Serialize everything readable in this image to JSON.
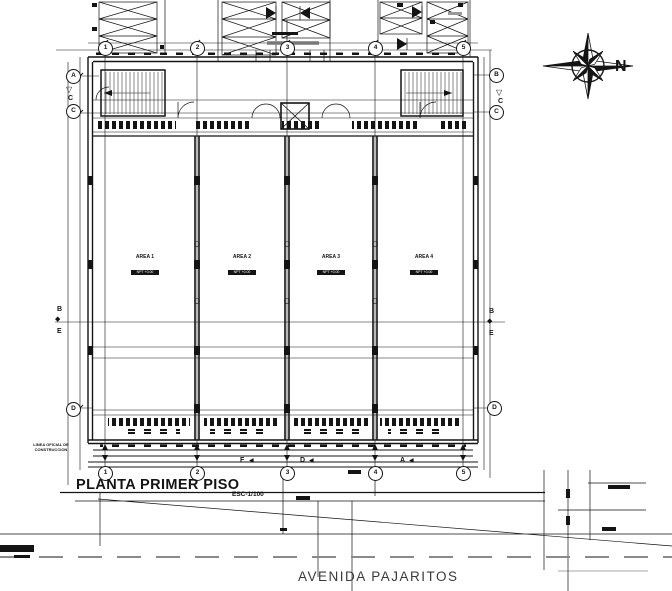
{
  "drawing": {
    "title": "PLANTA PRIMER PISO",
    "scale": "ESC-1/100",
    "street_name": "AVENIDA PAJARITOS",
    "north_label": "N",
    "margin_note_line1": "LINEA OFICIAL DE",
    "margin_note_line2": "CONSTRUCCION"
  },
  "grid": {
    "top_cols": [
      "1",
      "2",
      "3",
      "4",
      "5"
    ],
    "bottom_cols": [
      "1",
      "2",
      "3",
      "4",
      "5"
    ],
    "left_rows": [
      "A",
      "C",
      "D"
    ],
    "right_rows": [
      "B",
      "C",
      "D"
    ]
  },
  "section_markers": {
    "top_left": "C",
    "top_right": "C",
    "left_b": "B",
    "left_e": "E",
    "right_b": "B",
    "right_e": "E",
    "bottom_f": "F",
    "bottom_d": "D",
    "bottom_a": "A",
    "down_triangle": "▽",
    "left_triangle": "◀",
    "diamond": "◆"
  },
  "rooms": [
    {
      "name": "AREA 1",
      "level": "NPT +0.00"
    },
    {
      "name": "AREA 2",
      "level": "NPT +0.00"
    },
    {
      "name": "AREA 3",
      "level": "NPT +0.00"
    },
    {
      "name": "AREA 4",
      "level": "NPT +0.00"
    }
  ],
  "colors": {
    "ink": "#141414",
    "road_gray": "#8a8a8a"
  }
}
